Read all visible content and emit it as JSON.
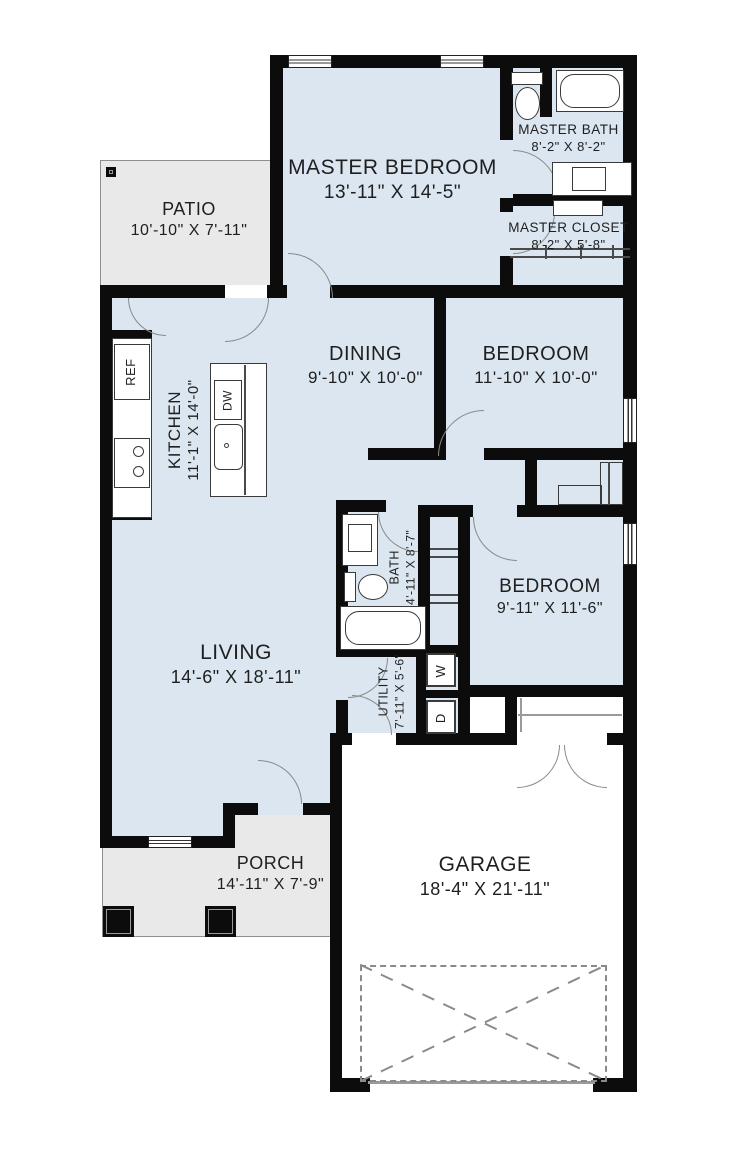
{
  "rooms": {
    "master_bedroom": {
      "name": "MASTER BEDROOM",
      "dims": "13'-11\" X 14'-5\""
    },
    "master_bath": {
      "name": "MASTER BATH",
      "dims": "8'-2\" X 8'-2\""
    },
    "master_closet": {
      "name": "MASTER CLOSET",
      "dims": "8'-2\" X 5'-8\""
    },
    "patio": {
      "name": "PATIO",
      "dims": "10'-10\" X 7'-11\""
    },
    "dining": {
      "name": "DINING",
      "dims": "9'-10\" X 10'-0\""
    },
    "bedroom_mid": {
      "name": "BEDROOM",
      "dims": "11'-10\" X 10'-0\""
    },
    "kitchen": {
      "name": "KITCHEN",
      "dims": "11'-1\" X 14'-0\""
    },
    "bath": {
      "name": "BATH",
      "dims": "4'-11\" X 8'-7\""
    },
    "bedroom_right": {
      "name": "BEDROOM",
      "dims": "9'-11\" X 11'-6\""
    },
    "living": {
      "name": "LIVING",
      "dims": "14'-6\" X 18'-11\""
    },
    "utility": {
      "name": "UTILITY",
      "dims": "7'-11\" X 5'-6\""
    },
    "porch": {
      "name": "PORCH",
      "dims": "14'-11\" X 7'-9\""
    },
    "garage": {
      "name": "GARAGE",
      "dims": "18'-4\" X 21'-11\""
    }
  },
  "appliances": {
    "refrigerator": "REF",
    "dishwasher": "DW",
    "washer": "W",
    "dryer": "D"
  },
  "colors": {
    "wall": "#0c0c0c",
    "interior_floor": "#dbe6f0",
    "outdoor_floor": "#e9e9ea",
    "garage_floor": "#ffffff"
  }
}
